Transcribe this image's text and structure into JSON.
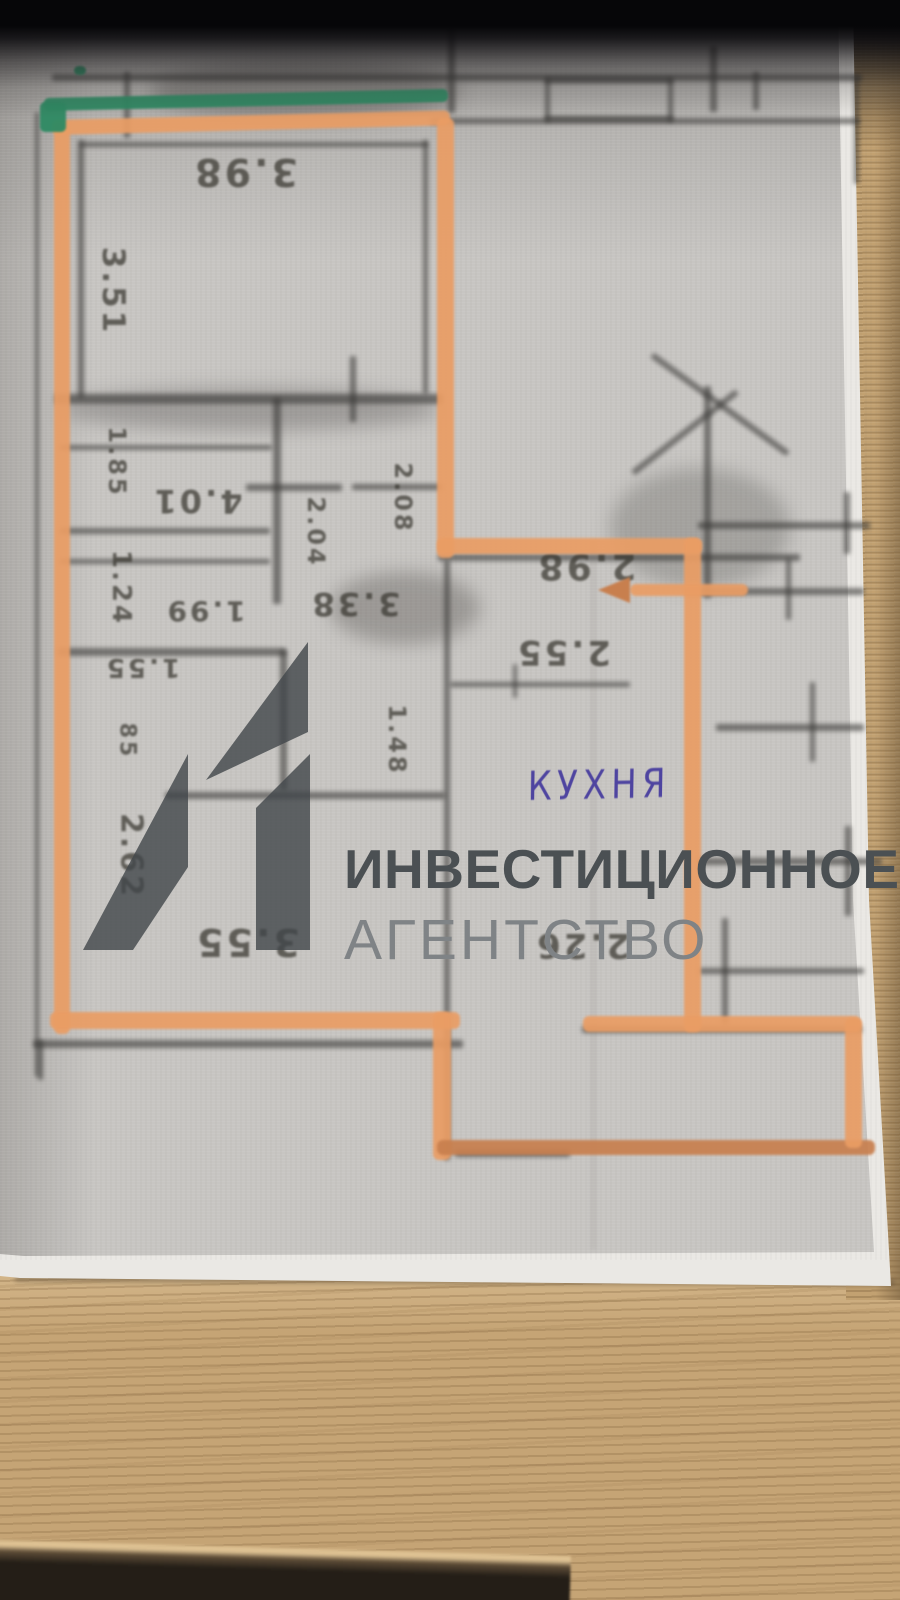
{
  "watermark": {
    "logo_mark": "41",
    "line1": "ИНВЕСТИЦИОННОЕ",
    "line2": "АГЕНТСТВО",
    "logo_color": "#41464a",
    "line1_color": "#4b5053",
    "line2_color": "#7f8386"
  },
  "handwriting": {
    "kitchen_label": "КУХНЯ",
    "ink_color": "#4e44a0"
  },
  "markers": {
    "orange": "#ea9d64",
    "orange_dark": "#c87f4e",
    "green": "#2e8a63"
  },
  "pencil": {
    "color": "#3b3a38"
  },
  "dimensions": [
    {
      "text": "3.98",
      "x": 245,
      "y": 172,
      "rot": 180,
      "size": 38
    },
    {
      "text": "3.51",
      "x": 113,
      "y": 291,
      "rot": 90,
      "size": 31
    },
    {
      "text": "1.85",
      "x": 117,
      "y": 462,
      "rot": 90,
      "size": 24
    },
    {
      "text": "4.01",
      "x": 197,
      "y": 501,
      "rot": 180,
      "size": 32
    },
    {
      "text": "2.04",
      "x": 316,
      "y": 532,
      "rot": 90,
      "size": 24
    },
    {
      "text": "2.08",
      "x": 403,
      "y": 498,
      "rot": 90,
      "size": 24
    },
    {
      "text": "1.24",
      "x": 121,
      "y": 588,
      "rot": 90,
      "size": 26
    },
    {
      "text": "1.99",
      "x": 205,
      "y": 611,
      "rot": 180,
      "size": 28
    },
    {
      "text": "3.38",
      "x": 355,
      "y": 604,
      "rot": 180,
      "size": 32
    },
    {
      "text": "1.55",
      "x": 142,
      "y": 667,
      "rot": 180,
      "size": 26
    },
    {
      "text": "85",
      "x": 127,
      "y": 741,
      "rot": 90,
      "size": 22
    },
    {
      "text": "2.62",
      "x": 131,
      "y": 856,
      "rot": 90,
      "size": 30
    },
    {
      "text": "3.55",
      "x": 247,
      "y": 942,
      "rot": 180,
      "size": 38
    },
    {
      "text": "2.98",
      "x": 586,
      "y": 566,
      "rot": 180,
      "size": 36
    },
    {
      "text": "2.55",
      "x": 563,
      "y": 652,
      "rot": 180,
      "size": 34
    },
    {
      "text": "1.48",
      "x": 397,
      "y": 740,
      "rot": 90,
      "size": 24
    },
    {
      "text": "2.26",
      "x": 582,
      "y": 945,
      "rot": 180,
      "size": 34
    }
  ],
  "floor_plan": {
    "walls": [
      [
        52,
        74,
        810,
        7
      ],
      [
        124,
        72,
        6,
        66
      ],
      [
        448,
        25,
        7,
        88
      ],
      [
        430,
        118,
        430,
        6
      ],
      [
        545,
        78,
        5,
        44
      ],
      [
        668,
        78,
        5,
        44
      ],
      [
        545,
        78,
        128,
        5
      ],
      [
        545,
        116,
        128,
        5
      ],
      [
        710,
        46,
        7,
        66
      ],
      [
        753,
        72,
        6,
        38
      ],
      [
        854,
        76,
        5,
        108
      ],
      [
        35,
        112,
        4,
        965
      ],
      [
        78,
        140,
        6,
        258
      ],
      [
        80,
        142,
        348,
        5
      ],
      [
        423,
        140,
        5,
        254
      ],
      [
        55,
        394,
        388,
        10
      ],
      [
        350,
        356,
        6,
        66
      ],
      [
        273,
        398,
        8,
        206
      ],
      [
        60,
        445,
        212,
        5
      ],
      [
        60,
        528,
        210,
        6
      ],
      [
        60,
        559,
        210,
        5
      ],
      [
        58,
        648,
        228,
        8
      ],
      [
        246,
        484,
        96,
        7
      ],
      [
        352,
        484,
        90,
        6
      ],
      [
        438,
        554,
        362,
        7
      ],
      [
        844,
        492,
        6,
        62
      ],
      [
        698,
        522,
        172,
        7
      ],
      [
        450,
        682,
        180,
        5
      ],
      [
        513,
        664,
        4,
        34
      ],
      [
        444,
        560,
        6,
        600
      ],
      [
        280,
        650,
        7,
        140
      ],
      [
        165,
        792,
        280,
        7
      ],
      [
        33,
        1040,
        430,
        8
      ],
      [
        38,
        1040,
        5,
        40
      ],
      [
        455,
        1150,
        115,
        7
      ],
      [
        582,
        1026,
        280,
        7
      ],
      [
        633,
        470,
        132,
        6,
        -38
      ],
      [
        652,
        352,
        168,
        6,
        36
      ],
      [
        704,
        386,
        7,
        212
      ],
      [
        686,
        588,
        178,
        7
      ],
      [
        786,
        558,
        5,
        62
      ],
      [
        716,
        724,
        148,
        7
      ],
      [
        810,
        682,
        5,
        80
      ],
      [
        698,
        858,
        184,
        7
      ],
      [
        845,
        826,
        6,
        90
      ],
      [
        698,
        968,
        166,
        6
      ],
      [
        722,
        918,
        6,
        106
      ]
    ],
    "marker_segments": [
      [
        52,
        120,
        398,
        15,
        -1.4,
        0
      ],
      [
        54,
        126,
        16,
        908,
        0,
        0
      ],
      [
        437,
        118,
        17,
        440,
        0,
        0
      ],
      [
        437,
        538,
        265,
        16,
        0,
        0
      ],
      [
        684,
        538,
        17,
        494,
        0,
        0
      ],
      [
        630,
        584,
        118,
        12,
        0,
        0
      ],
      [
        50,
        1012,
        410,
        17,
        0,
        0
      ],
      [
        433,
        1012,
        18,
        148,
        0,
        0
      ],
      [
        437,
        1140,
        438,
        15,
        0,
        1
      ],
      [
        845,
        1018,
        17,
        130,
        0,
        0
      ],
      [
        583,
        1016,
        278,
        16,
        0,
        0
      ]
    ],
    "green_segments": [
      [
        44,
        98,
        404,
        13,
        -1.3
      ],
      [
        40,
        102,
        26,
        30,
        0
      ],
      [
        74,
        66,
        12,
        9,
        0
      ]
    ],
    "arrow": {
      "x": 598,
      "y": 577
    }
  }
}
